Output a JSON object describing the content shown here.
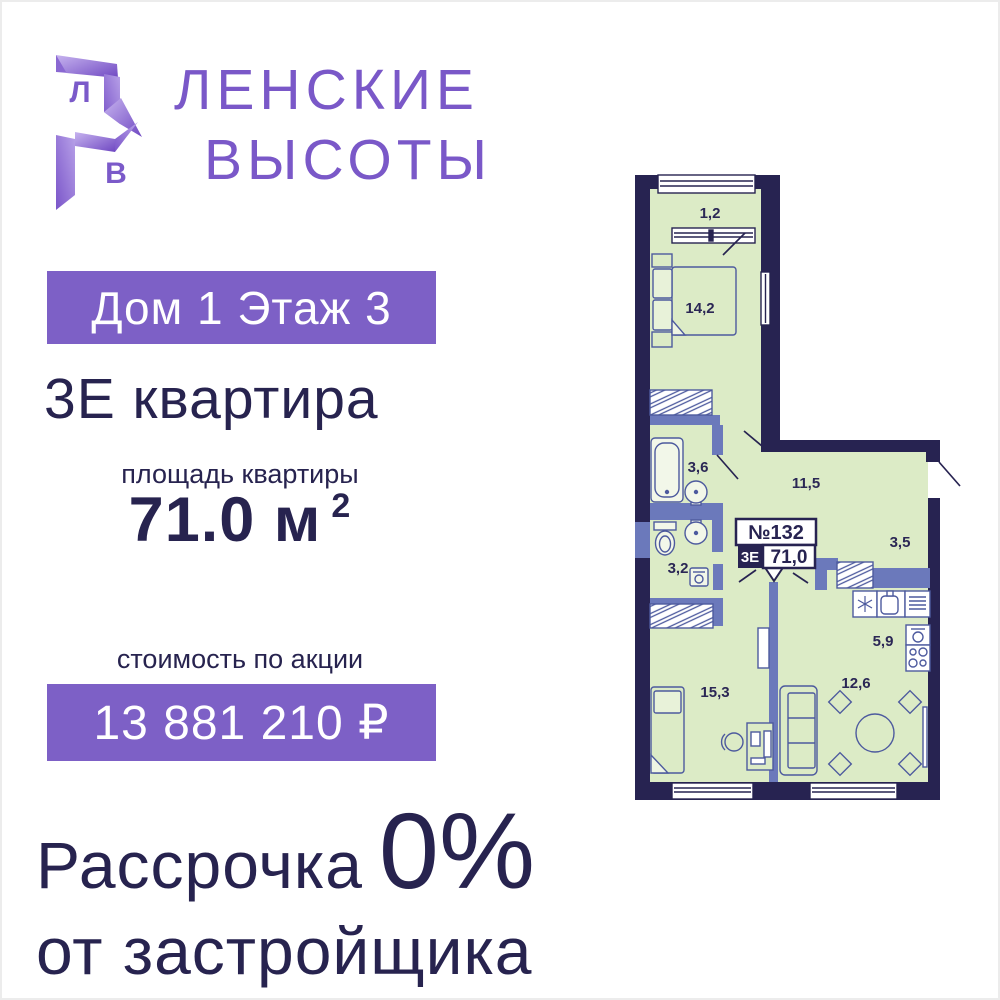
{
  "logo": {
    "monogram_top": "Л",
    "monogram_bottom": "В",
    "line1": "ЛЕНСКИЕ",
    "line2": "ВЫСОТЫ"
  },
  "header": {
    "house_floor_badge": "Дом 1 Этаж 3",
    "apartment_type": "3Е квартира"
  },
  "area": {
    "label": "площадь квартиры",
    "value": "71.0 м",
    "sup": "2"
  },
  "price": {
    "label": "стоимость по акции",
    "value": "13 881 210 ₽"
  },
  "promo": {
    "word": "Рассрочка",
    "big": "0%",
    "line2": "от застройщика"
  },
  "floorplan": {
    "unit_number": "№132",
    "unit_type": "3Е",
    "unit_area": "71,0",
    "rooms": [
      {
        "name": "balcony",
        "area": "1,2"
      },
      {
        "name": "bedroom",
        "area": "14,2"
      },
      {
        "name": "bathroom",
        "area": "3,6"
      },
      {
        "name": "corridor",
        "area": "11,5"
      },
      {
        "name": "hall",
        "area": "3,5"
      },
      {
        "name": "wc",
        "area": "3,2"
      },
      {
        "name": "kitchen",
        "area": "5,9"
      },
      {
        "name": "bedroom2",
        "area": "15,3"
      },
      {
        "name": "living",
        "area": "12,6"
      }
    ]
  },
  "colors": {
    "accent_purple": "#7d60c6",
    "logo_purple": "#7a58c8",
    "navy": "#27234f",
    "plan_wall": "#272351",
    "plan_room_green": "#dcebc6",
    "plan_inner_wall": "#6b79bb"
  }
}
